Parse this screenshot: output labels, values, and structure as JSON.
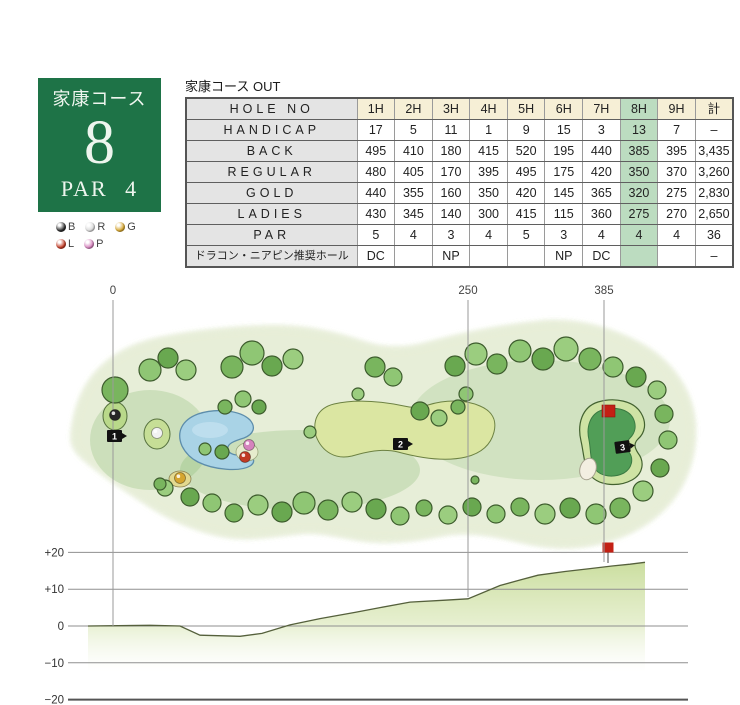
{
  "hole_card": {
    "course_name": "家康コース",
    "hole_number": "8",
    "par_label": "PAR 4",
    "bg_color": "#1e7347"
  },
  "tee_legend": {
    "rows": [
      [
        {
          "code": "B",
          "color": "#2b2b2b"
        },
        {
          "code": "R",
          "color": "#d9d9d9"
        },
        {
          "code": "G",
          "color": "#d5a52f"
        }
      ],
      [
        {
          "code": "L",
          "color": "#c03a24"
        },
        {
          "code": "P",
          "color": "#d583bd"
        }
      ]
    ]
  },
  "score_table": {
    "title": "家康コース OUT",
    "highlight_column_index": 7,
    "rows": [
      {
        "label": "HOLE NO",
        "is_header": true,
        "cells": [
          "1H",
          "2H",
          "3H",
          "4H",
          "5H",
          "6H",
          "7H",
          "8H",
          "9H",
          "計"
        ]
      },
      {
        "label": "HANDICAP",
        "cells": [
          "17",
          "5",
          "11",
          "1",
          "9",
          "15",
          "3",
          "13",
          "7",
          "–"
        ]
      },
      {
        "label": "BACK",
        "cells": [
          "495",
          "410",
          "180",
          "415",
          "520",
          "195",
          "440",
          "385",
          "395",
          "3,435"
        ]
      },
      {
        "label": "REGULAR",
        "cells": [
          "480",
          "405",
          "170",
          "395",
          "495",
          "175",
          "420",
          "350",
          "370",
          "3,260"
        ]
      },
      {
        "label": "GOLD",
        "cells": [
          "440",
          "355",
          "160",
          "350",
          "420",
          "145",
          "365",
          "320",
          "275",
          "2,830"
        ]
      },
      {
        "label": "LADIES",
        "cells": [
          "430",
          "345",
          "140",
          "300",
          "415",
          "115",
          "360",
          "275",
          "270",
          "2,650"
        ]
      },
      {
        "label": "PAR",
        "cells": [
          "5",
          "4",
          "3",
          "4",
          "5",
          "3",
          "4",
          "4",
          "4",
          "36"
        ]
      },
      {
        "label": "ドラコン・ニアピン推奨ホール",
        "is_jp": true,
        "cells": [
          "DC",
          "",
          "NP",
          "",
          "",
          "NP",
          "DC",
          "",
          "",
          "–"
        ]
      }
    ]
  },
  "map": {
    "distance_markers": [
      {
        "label": "0",
        "x": 113
      },
      {
        "label": "250",
        "x": 468
      },
      {
        "label": "385",
        "x": 604
      }
    ],
    "camera_markers": [
      {
        "label": "1",
        "x": 107,
        "y": 430
      },
      {
        "label": "2",
        "x": 393,
        "y": 438
      },
      {
        "label": "3",
        "x": 615,
        "y": 441
      }
    ],
    "tee_points": [
      {
        "code": "B",
        "color": "#262626",
        "x": 115,
        "y": 415
      },
      {
        "code": "R",
        "color": "#f2f2f2",
        "x": 157,
        "y": 433
      },
      {
        "code": "G",
        "color": "#d5a52f",
        "x": 180,
        "y": 478
      },
      {
        "code": "P",
        "color": "#d583bd",
        "x": 249,
        "y": 445
      },
      {
        "code": "L",
        "color": "#c03a24",
        "x": 245,
        "y": 457
      }
    ],
    "flag_color": "#c32014"
  },
  "chart_data": {
    "type": "area",
    "title": "hole elevation profile",
    "ylim": [
      -20,
      20
    ],
    "grid": true,
    "yticks": [
      {
        "label": "+20",
        "value": 20
      },
      {
        "label": "+10",
        "value": 10
      },
      {
        "label": "0",
        "value": 0
      },
      {
        "label": "−10",
        "value": -10
      },
      {
        "label": "−20",
        "value": -20
      }
    ],
    "x_markers": [
      "0",
      "250",
      "385"
    ],
    "profile_points_px_elev": [
      [
        88,
        0
      ],
      [
        150,
        0.2
      ],
      [
        180,
        0
      ],
      [
        200,
        -2.5
      ],
      [
        240,
        -2.8
      ],
      [
        262,
        -2
      ],
      [
        290,
        0.3
      ],
      [
        320,
        2
      ],
      [
        355,
        3.7
      ],
      [
        380,
        5
      ],
      [
        410,
        6.5
      ],
      [
        445,
        7
      ],
      [
        468,
        7.4
      ],
      [
        500,
        11
      ],
      [
        520,
        12.5
      ],
      [
        538,
        13.8
      ],
      [
        565,
        14.8
      ],
      [
        590,
        15.6
      ],
      [
        612,
        16.3
      ],
      [
        630,
        16.8
      ],
      [
        645,
        17.3
      ]
    ],
    "flag_x_px": 608
  }
}
